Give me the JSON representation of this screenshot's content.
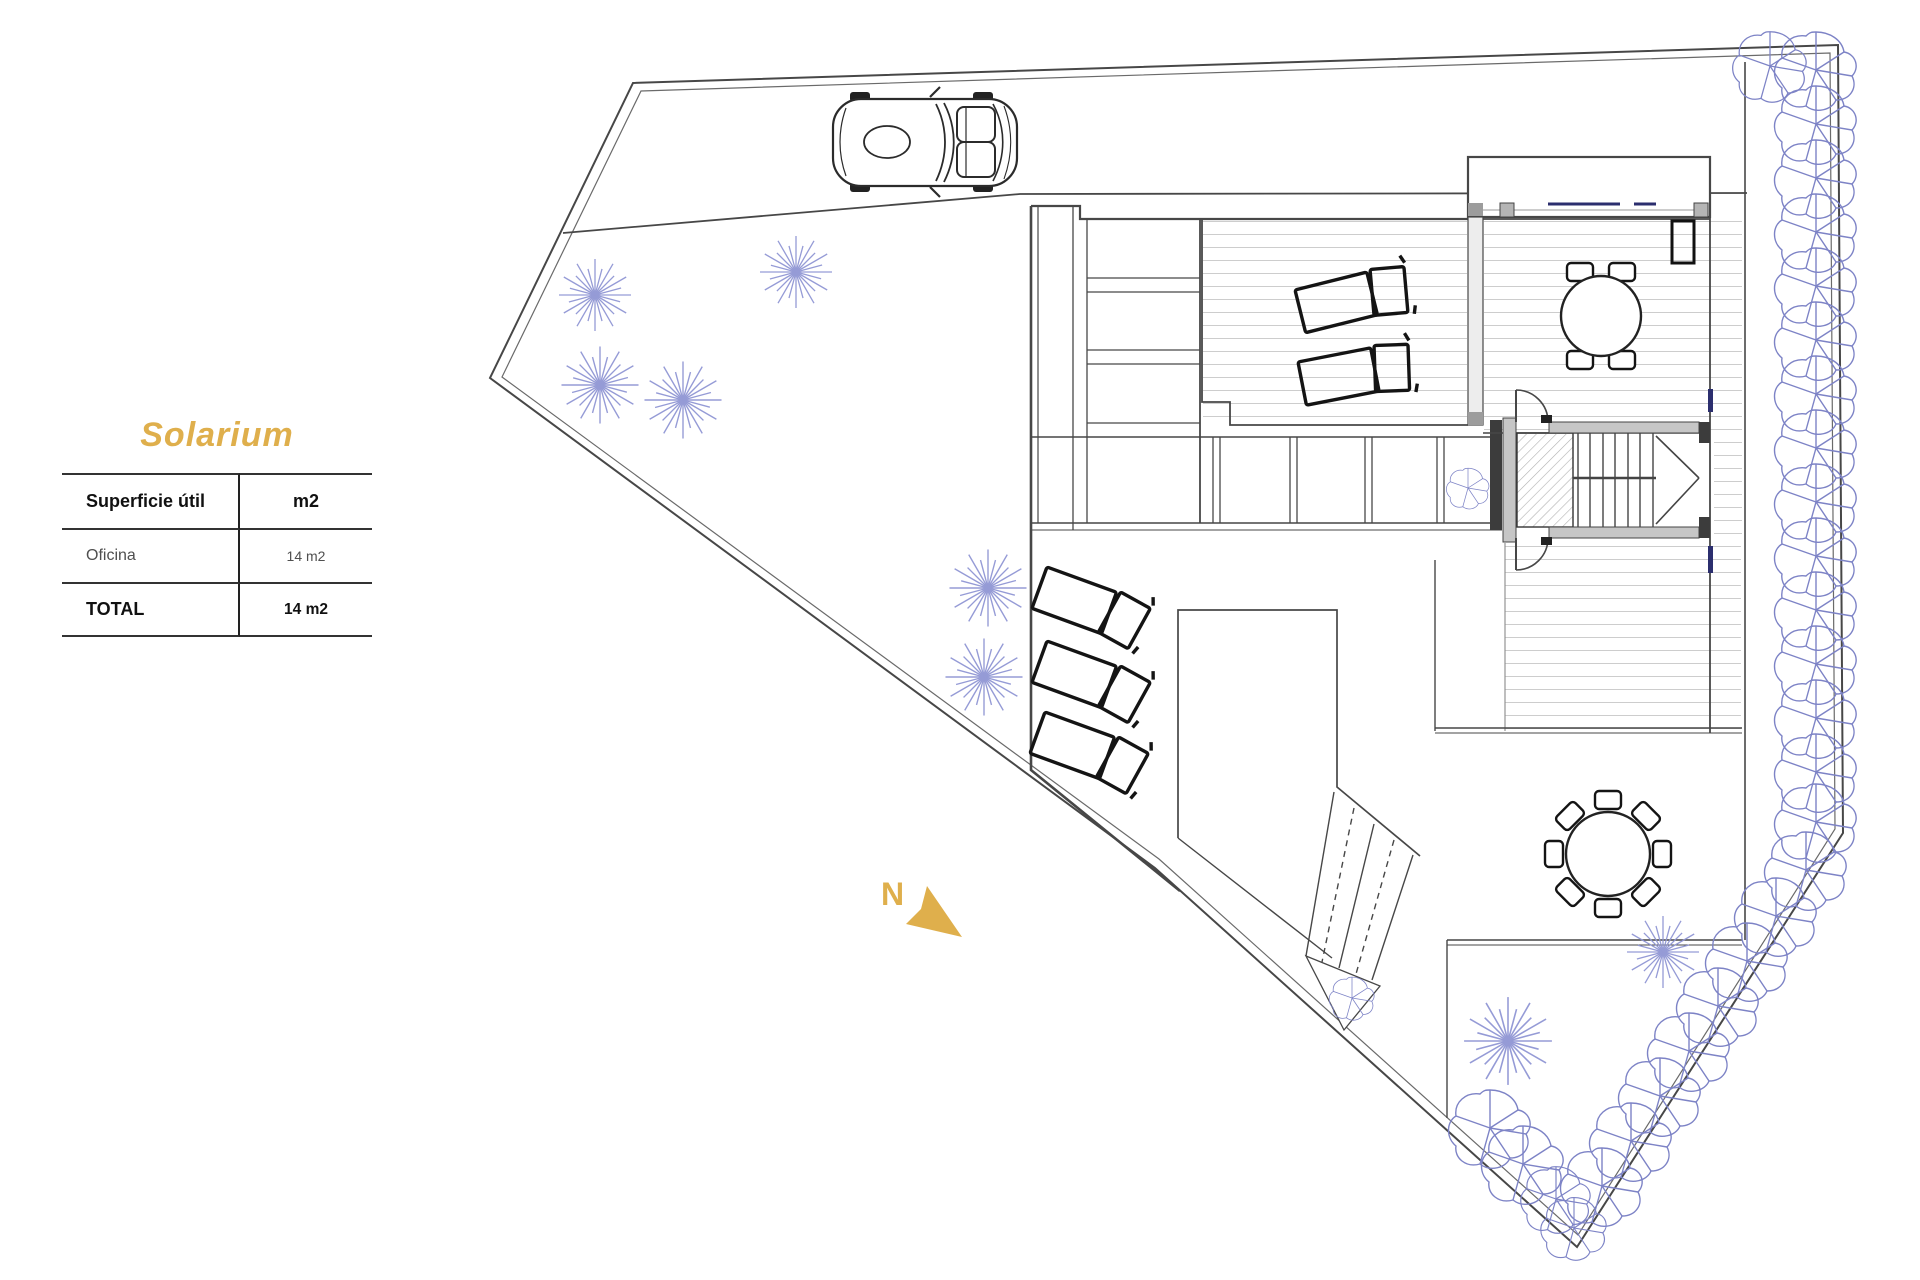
{
  "panel": {
    "title": "Solarium",
    "table": {
      "columns": [
        "Superficie útil",
        "m2"
      ],
      "rows": [
        {
          "concept": "Oficina",
          "area": "14 m2"
        }
      ],
      "total": {
        "concept": "TOTAL",
        "area": "14 m2"
      }
    }
  },
  "plan": {
    "north_label": "N",
    "symbols": [
      "site-boundary",
      "driveway",
      "car",
      "tree",
      "hedge-bush",
      "sun-lounger",
      "dining-table",
      "round-table-8-chairs",
      "staircase",
      "deck-terrace",
      "north-arrow"
    ]
  },
  "colors": {
    "gold": "#DFAF4C",
    "line": "#474747",
    "wall_gray": "#c6c6c6",
    "wall_dark": "#3c3c3c",
    "deck_line": "#cdcdcd",
    "tree": "#9096D4",
    "bush": "#7D83C6",
    "glazing": "#2B2E6E"
  }
}
